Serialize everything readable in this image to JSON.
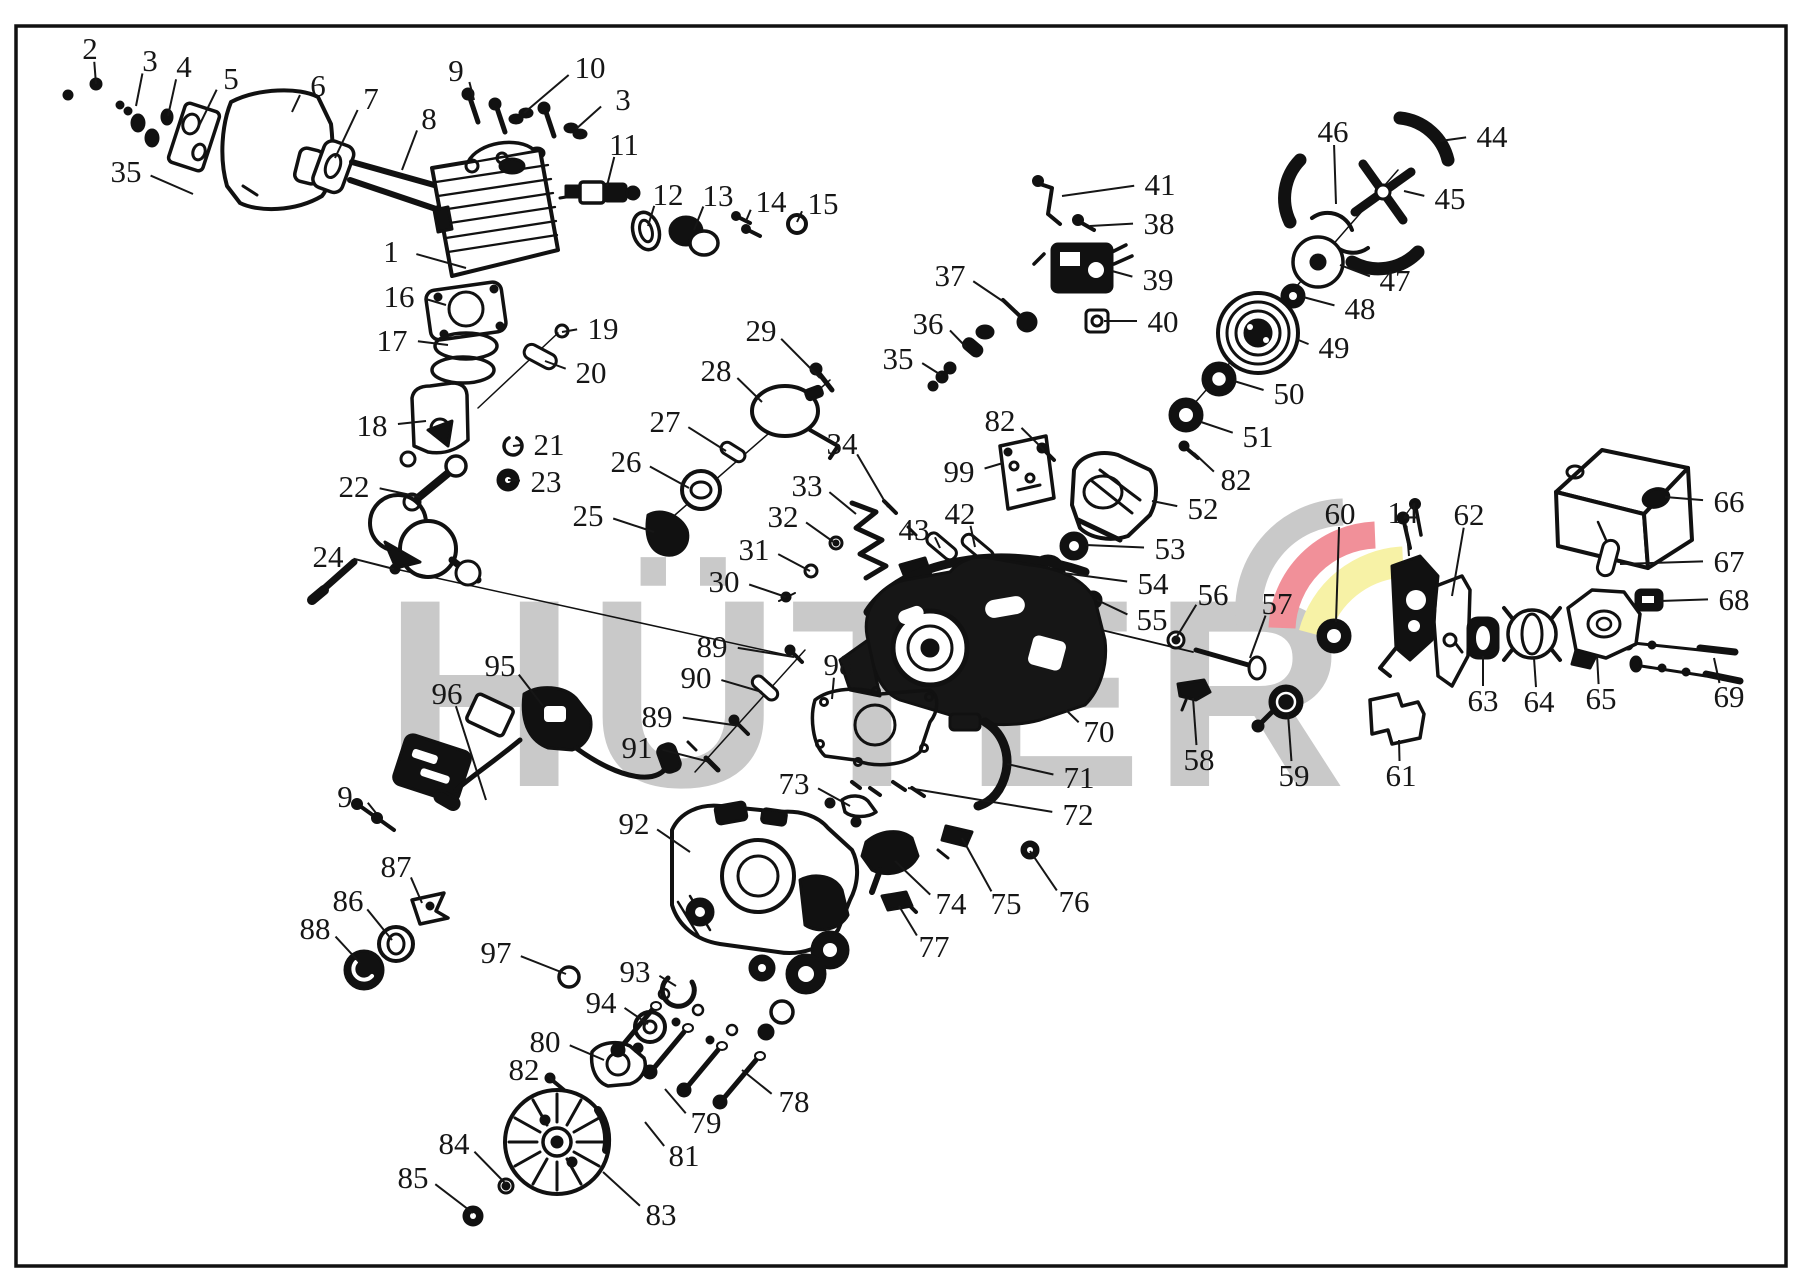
{
  "meta": {
    "doc_type": "exploded-parts-diagram"
  },
  "watermark": {
    "text": "HÜTER",
    "color": "#c9c9c9",
    "swoosh_colors": [
      "#c9c9c9",
      "#f19099",
      "#f7f2a6"
    ]
  },
  "callouts": [
    {
      "n": "2",
      "x": 90,
      "y": 48,
      "tx": 96,
      "ty": 84
    },
    {
      "n": "3",
      "x": 150,
      "y": 60,
      "tx": 136,
      "ty": 106
    },
    {
      "n": "4",
      "x": 184,
      "y": 66,
      "tx": 168,
      "ty": 116
    },
    {
      "n": "5",
      "x": 231,
      "y": 78,
      "tx": 198,
      "ty": 128
    },
    {
      "n": "6",
      "x": 318,
      "y": 85,
      "tx": 292,
      "ty": 112
    },
    {
      "n": "7",
      "x": 371,
      "y": 98,
      "tx": 335,
      "ty": 158
    },
    {
      "n": "8",
      "x": 429,
      "y": 118,
      "tx": 402,
      "ty": 170
    },
    {
      "n": "9",
      "x": 456,
      "y": 70,
      "tx": 474,
      "ty": 100
    },
    {
      "n": "10",
      "x": 590,
      "y": 67,
      "tx": 524,
      "ty": 113
    },
    {
      "n": "3",
      "x": 623,
      "y": 99,
      "tx": 576,
      "ty": 129
    },
    {
      "n": "11",
      "x": 624,
      "y": 144,
      "tx": 607,
      "ty": 186
    },
    {
      "n": "35",
      "x": 126,
      "y": 171,
      "tx": 193,
      "ty": 194
    },
    {
      "n": "1",
      "x": 391,
      "y": 251,
      "tx": 466,
      "ty": 268
    },
    {
      "n": "12",
      "x": 668,
      "y": 194,
      "tx": 648,
      "ty": 226
    },
    {
      "n": "13",
      "x": 718,
      "y": 195,
      "tx": 694,
      "ty": 230
    },
    {
      "n": "14",
      "x": 771,
      "y": 201,
      "tx": 746,
      "ty": 221
    },
    {
      "n": "15",
      "x": 823,
      "y": 203,
      "tx": 797,
      "ty": 222
    },
    {
      "n": "16",
      "x": 399,
      "y": 296,
      "tx": 446,
      "ty": 305
    },
    {
      "n": "17",
      "x": 392,
      "y": 340,
      "tx": 448,
      "ty": 345
    },
    {
      "n": "19",
      "x": 603,
      "y": 328,
      "tx": 562,
      "ty": 332
    },
    {
      "n": "20",
      "x": 591,
      "y": 372,
      "tx": 545,
      "ty": 361
    },
    {
      "n": "18",
      "x": 372,
      "y": 425,
      "tx": 426,
      "ty": 421
    },
    {
      "n": "21",
      "x": 549,
      "y": 444,
      "tx": 513,
      "ty": 446
    },
    {
      "n": "23",
      "x": 546,
      "y": 481,
      "tx": 508,
      "ty": 480
    },
    {
      "n": "22",
      "x": 354,
      "y": 486,
      "tx": 420,
      "ty": 497
    },
    {
      "n": "24",
      "x": 328,
      "y": 556,
      "tx": 394,
      "ty": 569
    },
    {
      "n": "25",
      "x": 588,
      "y": 515,
      "tx": 654,
      "ty": 532
    },
    {
      "n": "26",
      "x": 626,
      "y": 461,
      "tx": 689,
      "ty": 488
    },
    {
      "n": "27",
      "x": 665,
      "y": 421,
      "tx": 726,
      "ty": 451
    },
    {
      "n": "28",
      "x": 716,
      "y": 370,
      "tx": 762,
      "ty": 402
    },
    {
      "n": "29",
      "x": 761,
      "y": 330,
      "tx": 820,
      "ty": 378
    },
    {
      "n": "30",
      "x": 724,
      "y": 581,
      "tx": 786,
      "ty": 597
    },
    {
      "n": "31",
      "x": 754,
      "y": 549,
      "tx": 810,
      "ty": 571
    },
    {
      "n": "32",
      "x": 783,
      "y": 516,
      "tx": 835,
      "ty": 543
    },
    {
      "n": "33",
      "x": 807,
      "y": 485,
      "tx": 856,
      "ty": 514
    },
    {
      "n": "34",
      "x": 842,
      "y": 443,
      "tx": 888,
      "ty": 507
    },
    {
      "n": "43",
      "x": 914,
      "y": 529,
      "tx": 940,
      "ty": 548
    },
    {
      "n": "42",
      "x": 960,
      "y": 513,
      "tx": 975,
      "ty": 547
    },
    {
      "n": "99",
      "x": 959,
      "y": 471,
      "tx": 1003,
      "ty": 463
    },
    {
      "n": "82",
      "x": 1000,
      "y": 420,
      "tx": 1044,
      "ty": 450
    },
    {
      "n": "37",
      "x": 950,
      "y": 275,
      "tx": 1004,
      "ty": 302
    },
    {
      "n": "36",
      "x": 928,
      "y": 323,
      "tx": 966,
      "ty": 347
    },
    {
      "n": "35",
      "x": 898,
      "y": 358,
      "tx": 941,
      "ty": 375
    },
    {
      "n": "41",
      "x": 1160,
      "y": 184,
      "tx": 1062,
      "ty": 196
    },
    {
      "n": "38",
      "x": 1159,
      "y": 223,
      "tx": 1090,
      "ty": 226
    },
    {
      "n": "39",
      "x": 1158,
      "y": 279,
      "tx": 1112,
      "ty": 271
    },
    {
      "n": "40",
      "x": 1163,
      "y": 321,
      "tx": 1104,
      "ty": 321
    },
    {
      "n": "46",
      "x": 1333,
      "y": 131,
      "tx": 1336,
      "ty": 204
    },
    {
      "n": "44",
      "x": 1492,
      "y": 136,
      "tx": 1440,
      "ty": 141
    },
    {
      "n": "45",
      "x": 1450,
      "y": 198,
      "tx": 1404,
      "ty": 191
    },
    {
      "n": "47",
      "x": 1395,
      "y": 280,
      "tx": 1340,
      "ty": 265
    },
    {
      "n": "48",
      "x": 1360,
      "y": 308,
      "tx": 1303,
      "ty": 297
    },
    {
      "n": "49",
      "x": 1334,
      "y": 347,
      "tx": 1296,
      "ty": 339
    },
    {
      "n": "50",
      "x": 1289,
      "y": 393,
      "tx": 1234,
      "ty": 381
    },
    {
      "n": "51",
      "x": 1258,
      "y": 436,
      "tx": 1201,
      "ty": 422
    },
    {
      "n": "82",
      "x": 1236,
      "y": 479,
      "tx": 1194,
      "ty": 453
    },
    {
      "n": "52",
      "x": 1203,
      "y": 508,
      "tx": 1152,
      "ty": 501
    },
    {
      "n": "53",
      "x": 1170,
      "y": 548,
      "tx": 1086,
      "ty": 545
    },
    {
      "n": "54",
      "x": 1153,
      "y": 583,
      "tx": 1063,
      "ty": 573
    },
    {
      "n": "55",
      "x": 1152,
      "y": 619,
      "tx": 1097,
      "ty": 600
    },
    {
      "n": "56",
      "x": 1213,
      "y": 594,
      "tx": 1176,
      "ty": 638
    },
    {
      "n": "57",
      "x": 1277,
      "y": 603,
      "tx": 1250,
      "ty": 658
    },
    {
      "n": "60",
      "x": 1340,
      "y": 513,
      "tx": 1336,
      "ty": 622
    },
    {
      "n": "14",
      "x": 1403,
      "y": 512,
      "tx": 1409,
      "ty": 556
    },
    {
      "n": "62",
      "x": 1469,
      "y": 514,
      "tx": 1452,
      "ty": 596
    },
    {
      "n": "66",
      "x": 1729,
      "y": 501,
      "tx": 1665,
      "ty": 497
    },
    {
      "n": "67",
      "x": 1729,
      "y": 561,
      "tx": 1620,
      "ty": 564
    },
    {
      "n": "68",
      "x": 1734,
      "y": 599,
      "tx": 1660,
      "ty": 601
    },
    {
      "n": "69",
      "x": 1729,
      "y": 696,
      "tx": 1714,
      "ty": 658
    },
    {
      "n": "63",
      "x": 1483,
      "y": 700,
      "tx": 1483,
      "ty": 656
    },
    {
      "n": "64",
      "x": 1539,
      "y": 701,
      "tx": 1534,
      "ty": 658
    },
    {
      "n": "65",
      "x": 1601,
      "y": 698,
      "tx": 1597,
      "ty": 655
    },
    {
      "n": "61",
      "x": 1401,
      "y": 775,
      "tx": 1399,
      "ty": 740
    },
    {
      "n": "59",
      "x": 1294,
      "y": 775,
      "tx": 1288,
      "ty": 714
    },
    {
      "n": "58",
      "x": 1199,
      "y": 759,
      "tx": 1193,
      "ty": 698
    },
    {
      "n": "70",
      "x": 1099,
      "y": 731,
      "tx": 1035,
      "ty": 680
    },
    {
      "n": "71",
      "x": 1079,
      "y": 777,
      "tx": 1007,
      "ty": 764
    },
    {
      "n": "72",
      "x": 1078,
      "y": 814,
      "tx": 908,
      "ty": 788
    },
    {
      "n": "89",
      "x": 712,
      "y": 646,
      "tx": 794,
      "ty": 657
    },
    {
      "n": "90",
      "x": 696,
      "y": 677,
      "tx": 762,
      "ty": 692
    },
    {
      "n": "89",
      "x": 657,
      "y": 716,
      "tx": 740,
      "ty": 726
    },
    {
      "n": "91",
      "x": 637,
      "y": 747,
      "tx": 710,
      "ty": 762
    },
    {
      "n": "98",
      "x": 839,
      "y": 664,
      "tx": 832,
      "ty": 699
    },
    {
      "n": "95",
      "x": 500,
      "y": 665,
      "tx": 543,
      "ty": 706
    },
    {
      "n": "96",
      "x": 447,
      "y": 693,
      "tx": 486,
      "ty": 800
    },
    {
      "n": "9",
      "x": 345,
      "y": 796,
      "tx": 376,
      "ty": 813
    },
    {
      "n": "87",
      "x": 396,
      "y": 866,
      "tx": 422,
      "ty": 903
    },
    {
      "n": "86",
      "x": 348,
      "y": 900,
      "tx": 392,
      "ty": 940
    },
    {
      "n": "88",
      "x": 315,
      "y": 928,
      "tx": 360,
      "ty": 963
    },
    {
      "n": "92",
      "x": 634,
      "y": 823,
      "tx": 690,
      "ty": 852
    },
    {
      "n": "97",
      "x": 496,
      "y": 952,
      "tx": 566,
      "ty": 974
    },
    {
      "n": "93",
      "x": 635,
      "y": 971,
      "tx": 676,
      "ty": 986
    },
    {
      "n": "94",
      "x": 601,
      "y": 1002,
      "tx": 648,
      "ty": 1024
    },
    {
      "n": "80",
      "x": 545,
      "y": 1041,
      "tx": 604,
      "ty": 1060
    },
    {
      "n": "82",
      "x": 524,
      "y": 1069,
      "tx": 556,
      "ty": 1084
    },
    {
      "n": "74",
      "x": 951,
      "y": 903,
      "tx": 895,
      "ty": 861
    },
    {
      "n": "75",
      "x": 1006,
      "y": 903,
      "tx": 962,
      "ty": 838
    },
    {
      "n": "76",
      "x": 1074,
      "y": 901,
      "tx": 1030,
      "ty": 851
    },
    {
      "n": "77",
      "x": 934,
      "y": 946,
      "tx": 899,
      "ty": 906
    },
    {
      "n": "73",
      "x": 794,
      "y": 783,
      "tx": 850,
      "ty": 806
    },
    {
      "n": "78",
      "x": 794,
      "y": 1101,
      "tx": 742,
      "ty": 1070
    },
    {
      "n": "79",
      "x": 706,
      "y": 1122,
      "tx": 665,
      "ty": 1089
    },
    {
      "n": "81",
      "x": 684,
      "y": 1155,
      "tx": 645,
      "ty": 1122
    },
    {
      "n": "84",
      "x": 454,
      "y": 1143,
      "tx": 506,
      "ty": 1184
    },
    {
      "n": "85",
      "x": 413,
      "y": 1177,
      "tx": 473,
      "ty": 1213
    },
    {
      "n": "83",
      "x": 661,
      "y": 1214,
      "tx": 603,
      "ty": 1172
    }
  ]
}
